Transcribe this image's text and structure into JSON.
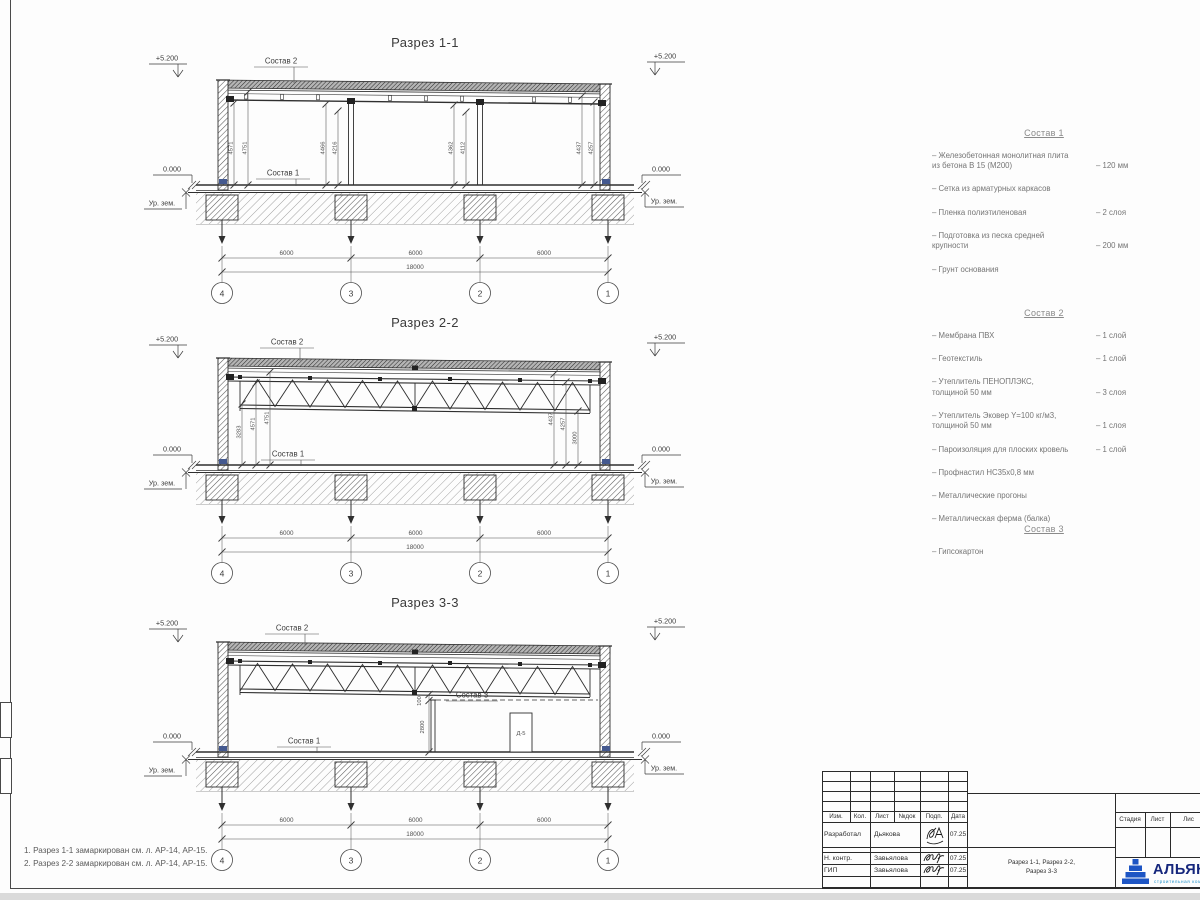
{
  "common": {
    "elev_top": "+5.200",
    "elev_zero": "0.000",
    "ground_label": "Ур. зем.",
    "dim_bay": "6000",
    "dim_total": "18000",
    "grid_bubbles": [
      "4",
      "3",
      "2",
      "1"
    ]
  },
  "sections": {
    "s1": {
      "title": "Разрез 1-1",
      "sostav1": "Состав 1",
      "sostav2": "Состав 2",
      "vdims": [
        "4571",
        "4751",
        "4466",
        "4216",
        "4362",
        "4112",
        "4437",
        "4257"
      ]
    },
    "s2": {
      "title": "Разрез 2-2",
      "sostav1": "Состав 1",
      "sostav2": "Состав 2",
      "vdims_left": [
        "3283",
        "4571",
        "4751"
      ],
      "vdims_right": [
        "4437",
        "4257",
        "3000"
      ]
    },
    "s3": {
      "title": "Разрез 3-3",
      "sostav1": "Состав 1",
      "sostav2": "Состав 2",
      "sostav3": "Состав 3",
      "door_label": "Д-5",
      "dim_ceiling_gap": "100",
      "dim_partition_height": "2800"
    }
  },
  "compositions": [
    {
      "title": "Состав 1",
      "items": [
        {
          "name": "– Железобетонная  монолитная плита\nиз бетона В 15 (М200)",
          "value": "– 120 мм"
        },
        {
          "name": "– Сетка из арматурных каркасов",
          "value": ""
        },
        {
          "name": "– Пленка полиэтиленовая",
          "value": "– 2 слоя"
        },
        {
          "name": "– Подготовка из песка средней\nкрупности",
          "value": "– 200 мм"
        },
        {
          "name": "– Грунт основания",
          "value": ""
        }
      ]
    },
    {
      "title": "Состав 2",
      "items": [
        {
          "name": "– Мембрана ПВХ",
          "value": "– 1 слой"
        },
        {
          "name": "– Геотекстиль",
          "value": "– 1 слой"
        },
        {
          "name": "– Утеплитель ПЕНОПЛЭКС,\nтолщиной 50 мм",
          "value": "– 3 слоя"
        },
        {
          "name": "– Утеплитель Эковер Y=100 кг/м3,\nтолщиной 50 мм",
          "value": "– 1 слоя"
        },
        {
          "name": "– Пароизоляция для плоских кровель",
          "value": "– 1 слой"
        },
        {
          "name": "– Профнастил НС35х0,8 мм",
          "value": ""
        },
        {
          "name": "– Металлические прогоны",
          "value": ""
        },
        {
          "name": "– Металлическая ферма (балка)",
          "value": ""
        }
      ]
    },
    {
      "title": "Состав 3",
      "items": [
        {
          "name": "– Гипсокартон",
          "value": ""
        }
      ]
    }
  ],
  "notes": [
    "1. Разрез 1-1 замаркирован см. л. АР-14, АР-15.",
    "2. Разрез 2-2 замаркирован см. л. АР-14, АР-15."
  ],
  "titleblock": {
    "col_headers": [
      "Изм.",
      "Кол.",
      "Лист",
      "№док",
      "Подп.",
      "Дата"
    ],
    "rows": [
      {
        "role": "Разработал",
        "name": "Дьякова",
        "date": "07.25"
      },
      {
        "role": "Н. контр.",
        "name": "Завьялова",
        "date": "07.25"
      },
      {
        "role": "ГИП",
        "name": "Завьялова",
        "date": "07.25"
      }
    ],
    "doc_title": "Разрез 1-1, Разрез 2-2,\nРазрез 3-3",
    "stage_headers": [
      "Стадия",
      "Лист",
      "Лис"
    ],
    "logo_text": "АЛЬЯНС",
    "logo_subtext": "строительная компания"
  }
}
